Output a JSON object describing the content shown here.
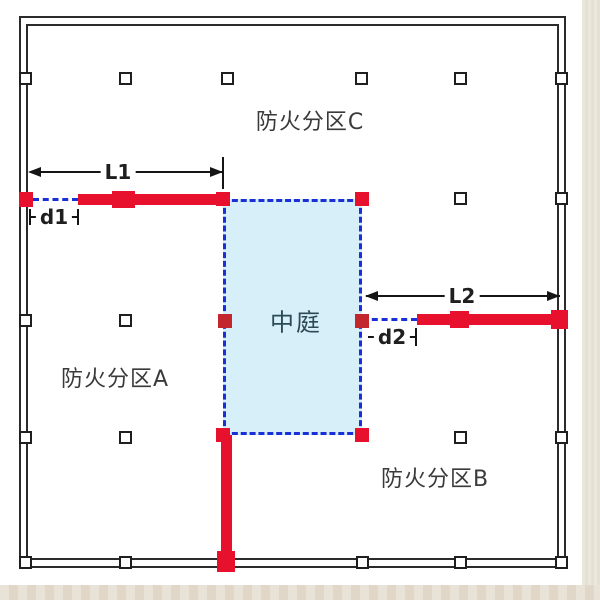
{
  "zones": {
    "zone_c": "防火分区C",
    "zone_a": "防火分区A",
    "zone_b": "防火分区B"
  },
  "atrium": {
    "label": "中庭"
  },
  "dimensions": {
    "L1": "L1",
    "d1": "d1",
    "L2": "L2",
    "d2": "d2"
  },
  "colors": {
    "fire_wall_red": "#e8112d",
    "fire_shutter_dark_red": "#c1272d",
    "atrium_fill": "#d6eff8",
    "atrium_text": "#2c4a56",
    "dashed_blue": "#1a2fd6",
    "line_black": "#2b2b2b",
    "canvas_white": "#ffffff",
    "page_beige": "#e9e6da"
  }
}
